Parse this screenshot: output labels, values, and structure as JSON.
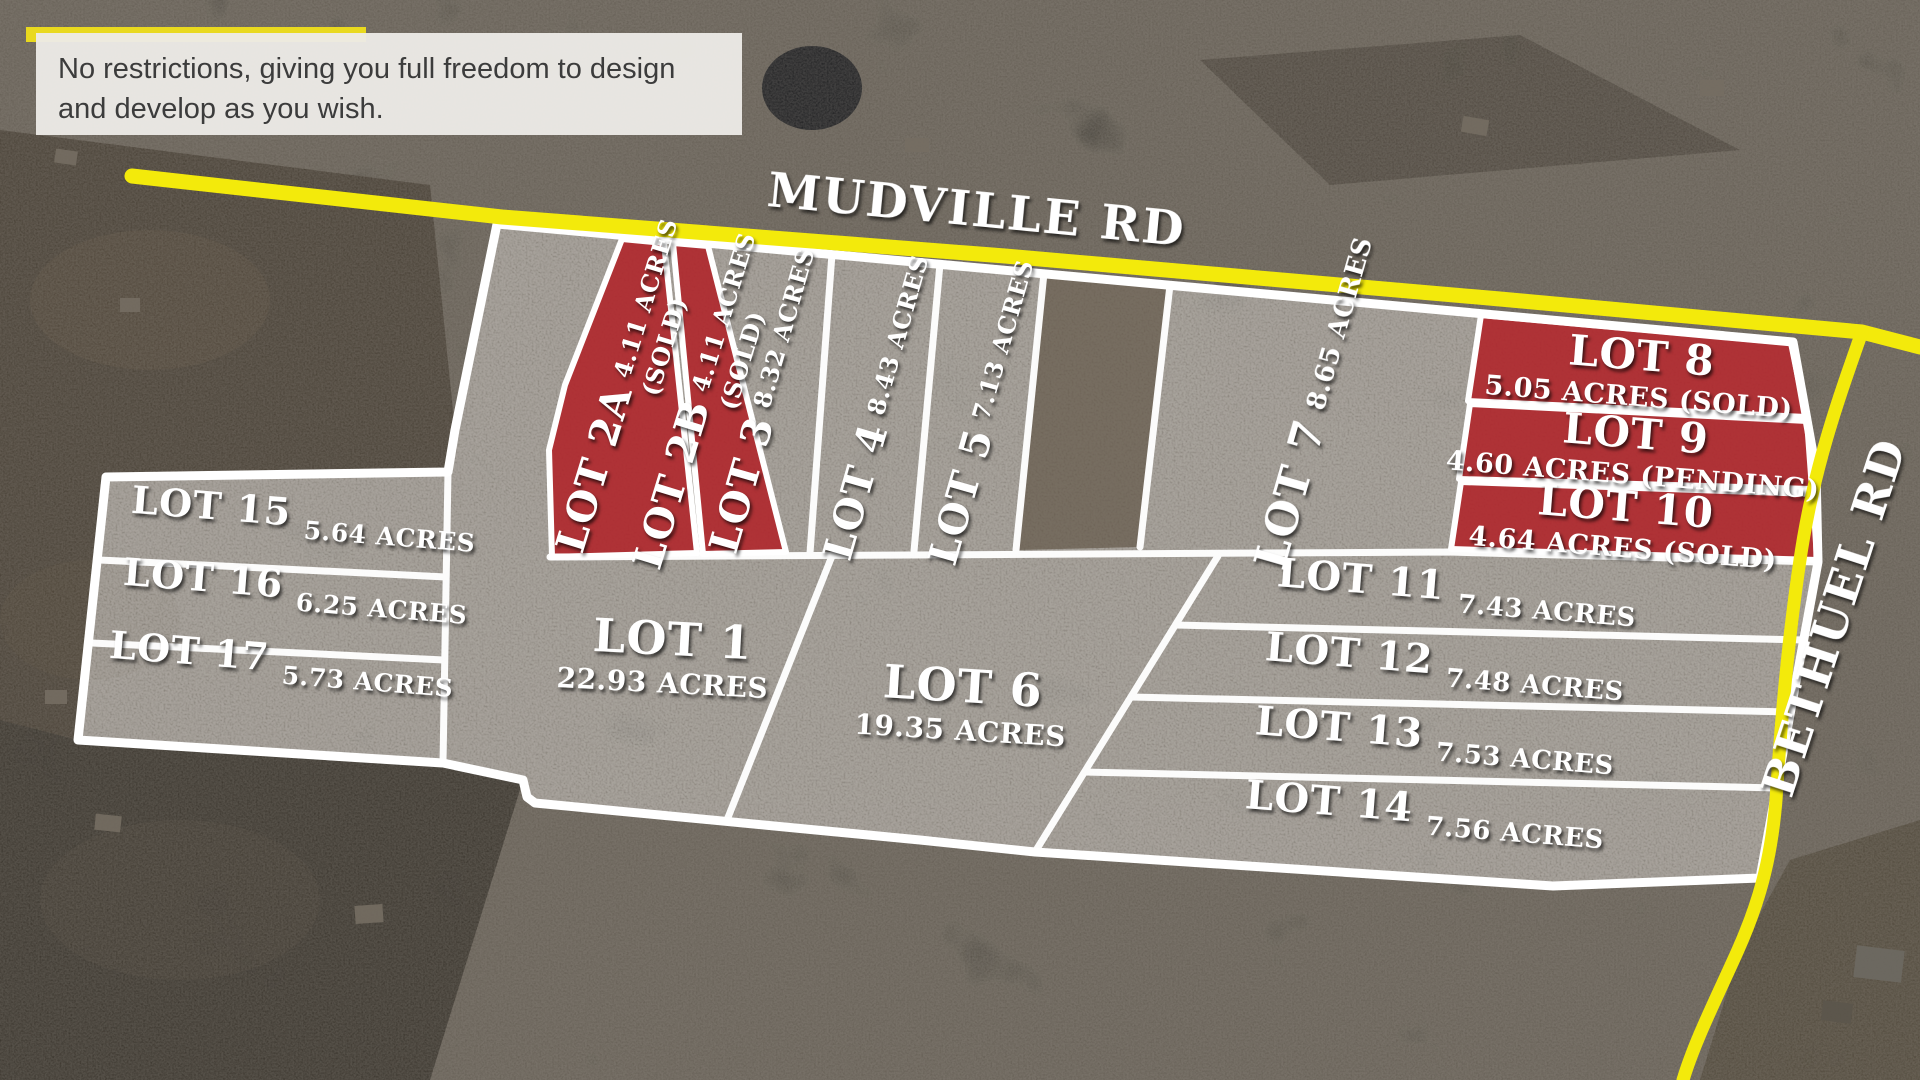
{
  "caption": {
    "line1": "No restrictions, giving you full freedom to design",
    "line2": "and develop as you wish."
  },
  "roads": {
    "mudville": "MUDVILLE RD",
    "bethuel": "BETHUEL RD"
  },
  "colors": {
    "road_yellow": "#f3ea0b",
    "sold_red": "#b02329",
    "boundary_white": "#ffffff",
    "caption_bg": "#eceae6",
    "caption_accent": "#e9d91e"
  },
  "lots": [
    {
      "id": "1",
      "name": "LOT 1",
      "acres": "22.93 ACRES",
      "status": ""
    },
    {
      "id": "2A",
      "name": "LOT 2A",
      "acres": "4.11 ACRES",
      "status": "(SOLD)"
    },
    {
      "id": "2B",
      "name": "LOT 2B",
      "acres": "4.11 ACRES",
      "status": "(SOLD)"
    },
    {
      "id": "3",
      "name": "LOT 3",
      "acres": "8.32 ACRES",
      "status": ""
    },
    {
      "id": "4",
      "name": "LOT 4",
      "acres": "8.43 ACRES",
      "status": ""
    },
    {
      "id": "5",
      "name": "LOT 5",
      "acres": "7.13 ACRES",
      "status": ""
    },
    {
      "id": "6",
      "name": "LOT 6",
      "acres": "19.35 ACRES",
      "status": ""
    },
    {
      "id": "7",
      "name": "LOT 7",
      "acres": "8.65 ACRES",
      "status": ""
    },
    {
      "id": "8",
      "name": "LOT 8",
      "acres": "5.05 ACRES (SOLD)",
      "status": "SOLD"
    },
    {
      "id": "9",
      "name": "LOT 9",
      "acres": "4.60 ACRES (PENDING)",
      "status": "PENDING"
    },
    {
      "id": "10",
      "name": "LOT 10",
      "acres": "4.64 ACRES (SOLD)",
      "status": "SOLD"
    },
    {
      "id": "11",
      "name": "LOT 11",
      "acres": "7.43 ACRES",
      "status": ""
    },
    {
      "id": "12",
      "name": "LOT 12",
      "acres": "7.48 ACRES",
      "status": ""
    },
    {
      "id": "13",
      "name": "LOT 13",
      "acres": "7.53 ACRES",
      "status": ""
    },
    {
      "id": "14",
      "name": "LOT 14",
      "acres": "7.56 ACRES",
      "status": ""
    },
    {
      "id": "15",
      "name": "LOT 15",
      "acres": "5.64 ACRES",
      "status": ""
    },
    {
      "id": "16",
      "name": "LOT 16",
      "acres": "6.25 ACRES",
      "status": ""
    },
    {
      "id": "17",
      "name": "LOT 17",
      "acres": "5.73 ACRES",
      "status": ""
    }
  ]
}
